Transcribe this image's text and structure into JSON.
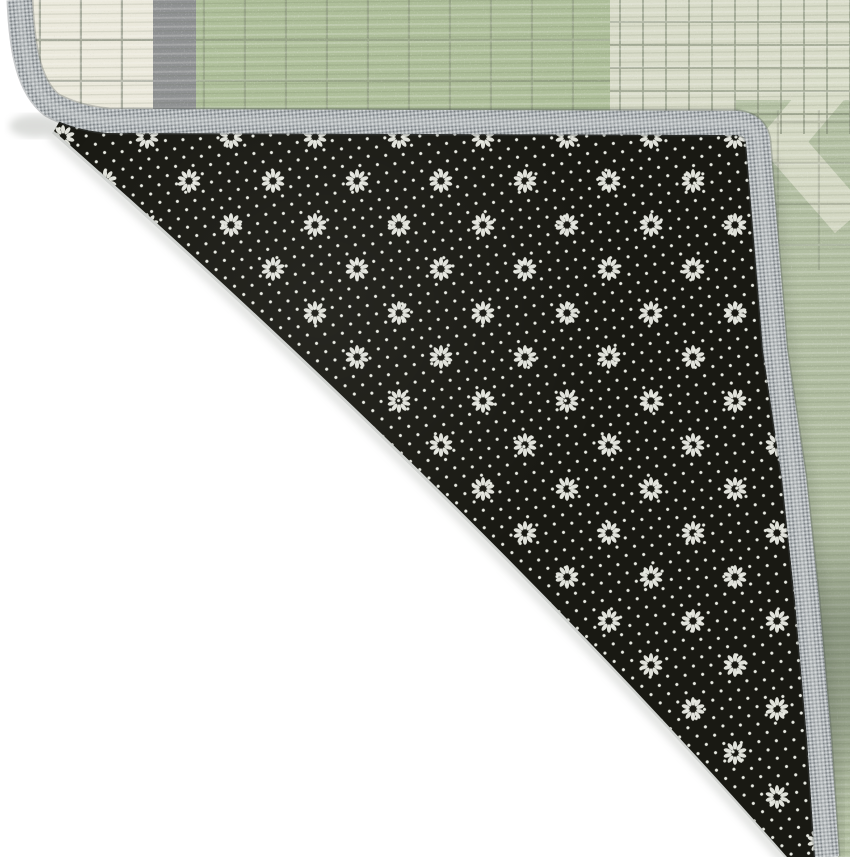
{
  "scene": {
    "type": "product-photo",
    "description": "Corner of a plaid low-pile area rug folded back to reveal its black non-slip dotted backing, on a plain white backdrop",
    "width_px": 850,
    "height_px": 857
  },
  "rug": {
    "front_face": {
      "pattern": "patchwork windowpane plaid",
      "blocks": [
        {
          "name": "cream-plaid-block",
          "color": "#ebe9dc",
          "grid_color": "#6b7263"
        },
        {
          "name": "gray-heather-stripe",
          "color": "#8f9192"
        },
        {
          "name": "sage-green-field",
          "color": "#aebe99",
          "grid_color": "#6b7263"
        },
        {
          "name": "pale-check-block",
          "color": "#d8dbc8",
          "grid_color": "#7d8671"
        },
        {
          "name": "right-green-strip",
          "color": "#b4c0a3"
        }
      ]
    },
    "backing": {
      "name": "non-slip-backing",
      "base_color": "#191913",
      "dot_color": "#e8eae2",
      "dot_spacing_px": 12.4,
      "dot_grid_rotation_deg": 42,
      "daisy_motif": {
        "petals": 10,
        "row_spacing_px": 44,
        "column_spacing_px": 84,
        "staggered": true
      }
    },
    "binding": {
      "name": "serged-edge-binding",
      "color": "#abb0b3",
      "knit_light": "#e0e3e4",
      "knit_dark": "#575d61",
      "width_px": 24
    }
  },
  "palette": {
    "backdrop": "#ffffff",
    "backing_black": "#191913",
    "backing_dot": "#e8eae2",
    "binding_gray": "#abb0b3",
    "binding_light": "#e0e3e4",
    "binding_dark": "#575d61",
    "binding_edge": "#4d5356",
    "cream_block": "#ebe9dc",
    "gray_stripe": "#8f9192",
    "green_field": "#aebe99",
    "pale_check": "#d8dbc8",
    "green_right": "#b4c0a3",
    "grid_line": "#6b7263",
    "grid_line_pale": "#7d8671",
    "shadow": "#3c463a",
    "crease_shadow": "#8a8f87"
  }
}
